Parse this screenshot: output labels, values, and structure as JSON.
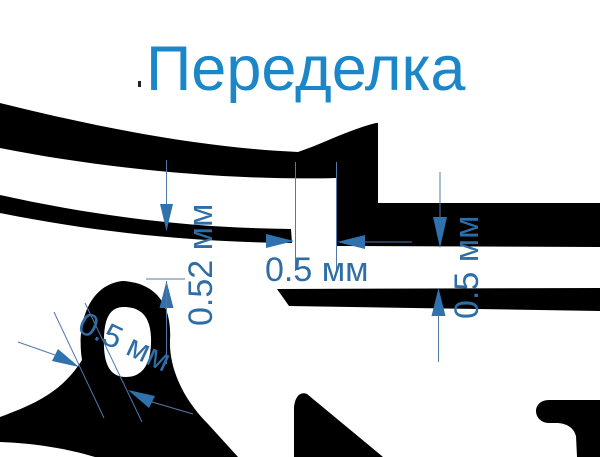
{
  "title": {
    "text": "Переделка",
    "color": "#1b87c9"
  },
  "dimensions": {
    "flange_clearance_vertical": {
      "label": "0.52 мм"
    },
    "slot_clearance_horizontal": {
      "label": "0.5 мм"
    },
    "right_gap_vertical": {
      "label": "0.5 мм"
    },
    "eyelet_wall_diagonal": {
      "label": "0.5 мм"
    }
  },
  "colors": {
    "dimension_text": "#2e6da6",
    "dimension_line": "#4f79ab",
    "arrow_fill": "#2f72ad",
    "part_fill": "#000000",
    "background": "#ffffff"
  }
}
